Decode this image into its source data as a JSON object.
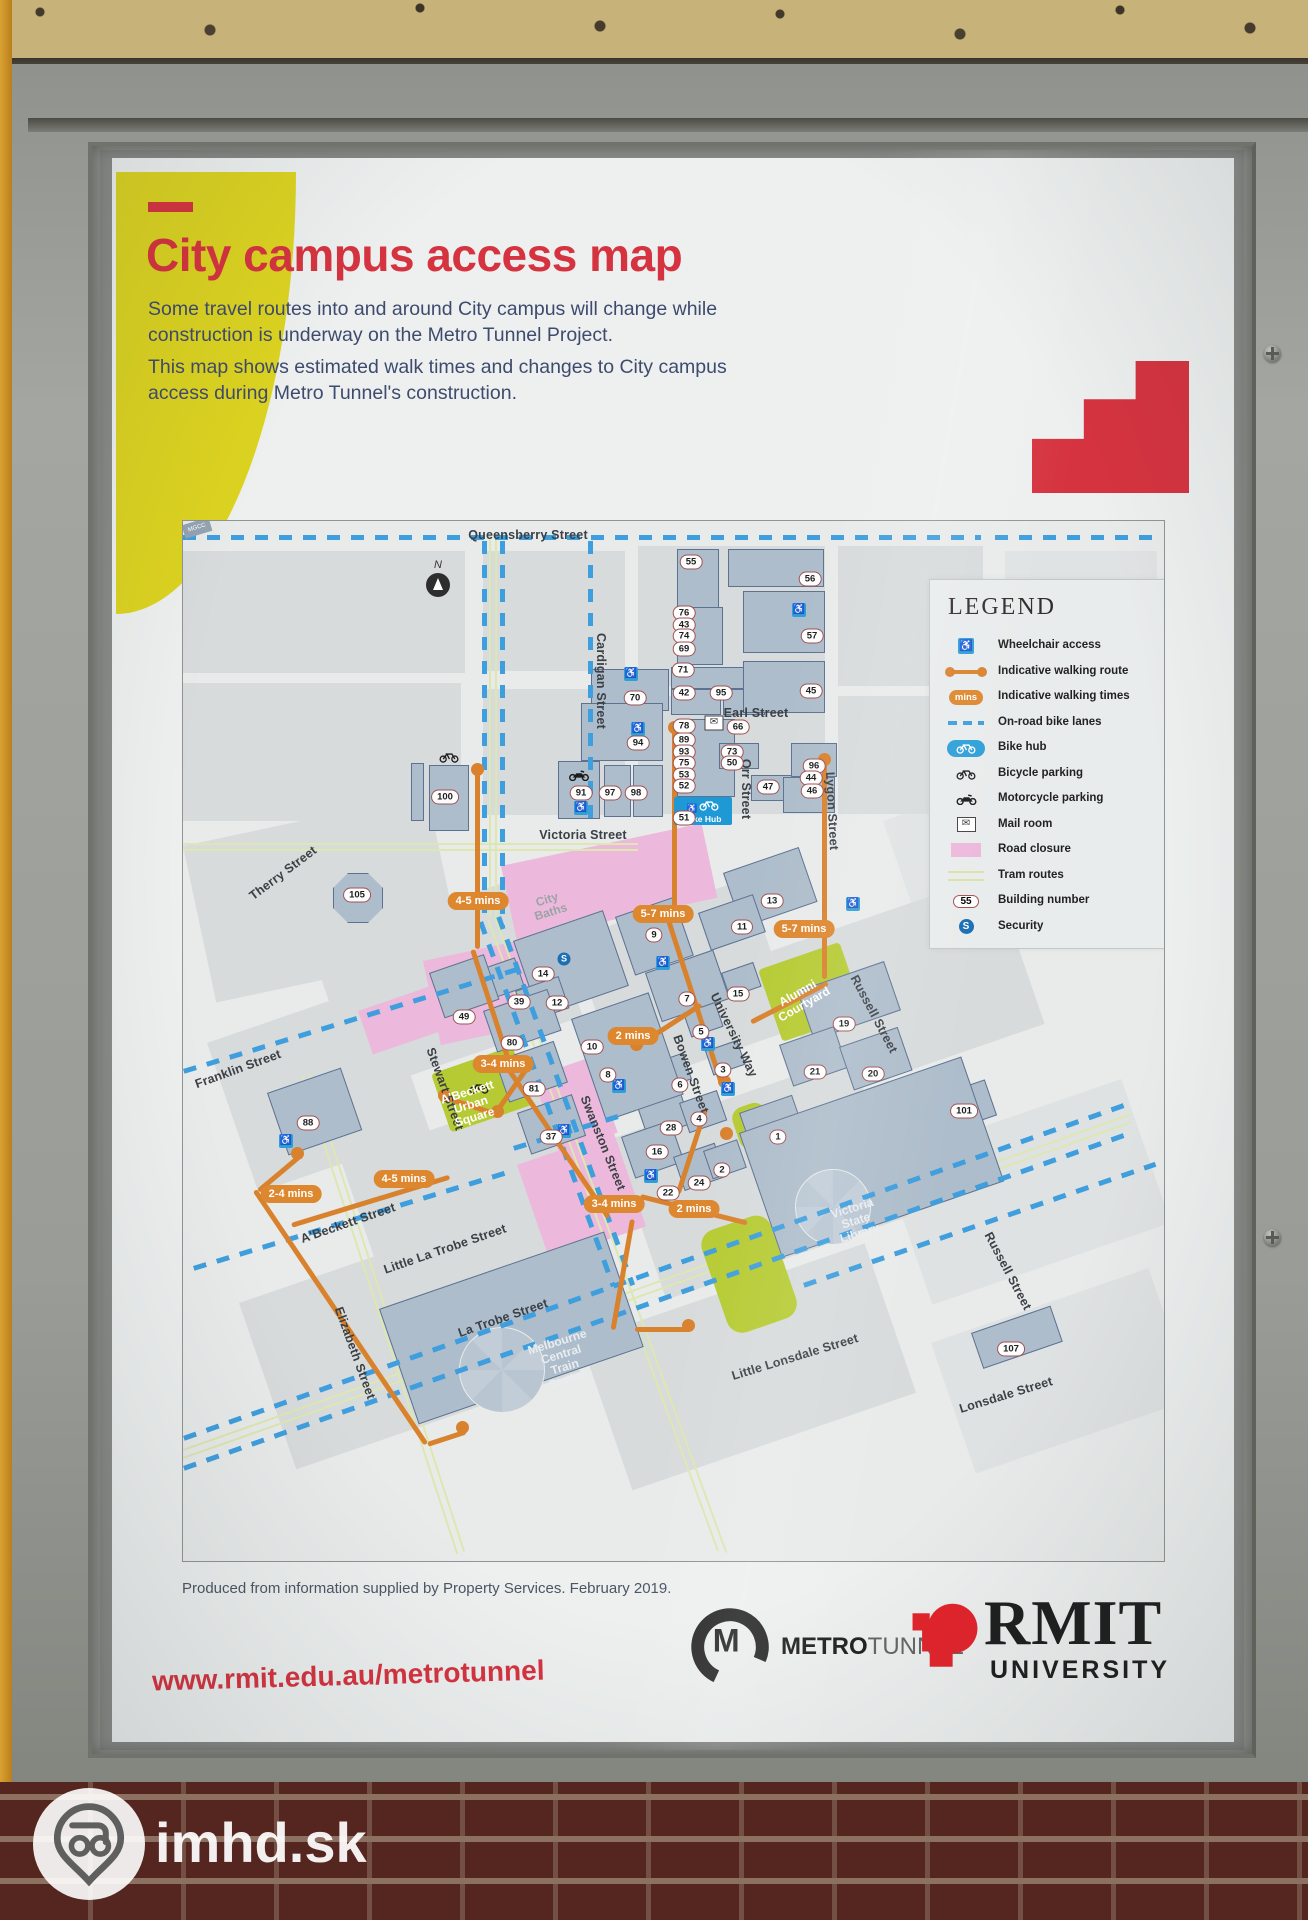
{
  "watermark": {
    "text": "imhd.sk"
  },
  "poster": {
    "title": "City campus access map",
    "intro1": "Some travel routes into and around City campus will change while\nconstruction is underway on the Metro Tunnel Project.",
    "intro2": "This map shows estimated walk times and changes to City campus\naccess during Metro Tunnel's construction.",
    "footnote": "Produced from information supplied by Property Services. February 2019.",
    "url": "www.rmit.edu.au/metrotunnel",
    "logos": {
      "metro_bold": "METRO",
      "metro_light": "TUNNEL",
      "rmit": "RMIT",
      "rmit_sub": "UNIVERSITY"
    }
  },
  "colors": {
    "title_red": "#d5333f",
    "rmit_red": "#e3242b",
    "route_orange": "#d9822e",
    "bike_lane_blue": "#3f9edd",
    "closure_pink": "#ecb9dc",
    "courtyard_green": "#b6cb33",
    "building_fill": "#aebdcb",
    "accent_yellow": "#dcd320",
    "bike_hub_blue": "#1f99d6"
  },
  "legend": {
    "title": "LEGEND",
    "mins_label": "mins",
    "building_number_sample": "55",
    "security_letter": "S",
    "items": [
      {
        "icon": "wheelchair-icon",
        "label": "Wheelchair access"
      },
      {
        "icon": "walking-route-icon",
        "label": "Indicative walking route"
      },
      {
        "icon": "walking-times-icon",
        "label": "Indicative walking times"
      },
      {
        "icon": "bike-lanes-icon",
        "label": "On-road bike lanes"
      },
      {
        "icon": "bike-hub-icon",
        "label": "Bike hub"
      },
      {
        "icon": "bicycle-parking-icon",
        "label": "Bicycle parking"
      },
      {
        "icon": "motorcycle-parking-icon",
        "label": "Motorcycle parking"
      },
      {
        "icon": "mail-room-icon",
        "label": "Mail room"
      },
      {
        "icon": "road-closure-icon",
        "label": "Road closure"
      },
      {
        "icon": "tram-routes-icon",
        "label": "Tram routes"
      },
      {
        "icon": "building-number-icon",
        "label": "Building number"
      },
      {
        "icon": "security-icon",
        "label": "Security"
      }
    ]
  },
  "map": {
    "north_label": "N",
    "bike_hub_label": "Bike Hub",
    "station_box_label": "MGCC",
    "street_labels": [
      {
        "text": "Queensberry Street",
        "x": 345,
        "y": 14,
        "rot": 0
      },
      {
        "text": "Cardigan Street",
        "x": 418,
        "y": 160,
        "rot": 90
      },
      {
        "text": "Earl Street",
        "x": 573,
        "y": 192,
        "rot": 0
      },
      {
        "text": "Orr Street",
        "x": 563,
        "y": 268,
        "rot": 90
      },
      {
        "text": "Lygon Street",
        "x": 649,
        "y": 290,
        "rot": 87
      },
      {
        "text": "Victoria Street",
        "x": 400,
        "y": 314,
        "rot": 0
      },
      {
        "text": "Therry Street",
        "x": 100,
        "y": 352,
        "rot": -37
      },
      {
        "text": "Franklin Street",
        "x": 55,
        "y": 548,
        "rot": -20
      },
      {
        "text": "Stewart Street",
        "x": 262,
        "y": 568,
        "rot": 70
      },
      {
        "text": "A'Beckett Street",
        "x": 165,
        "y": 702,
        "rot": -19
      },
      {
        "text": "Elizabeth Street",
        "x": 172,
        "y": 832,
        "rot": 70
      },
      {
        "text": "Little La Trobe Street",
        "x": 262,
        "y": 728,
        "rot": -19
      },
      {
        "text": "La Trobe Street",
        "x": 320,
        "y": 797,
        "rot": -19
      },
      {
        "text": "Swanston Street",
        "x": 420,
        "y": 622,
        "rot": 68
      },
      {
        "text": "Bowen Street",
        "x": 508,
        "y": 553,
        "rot": 70
      },
      {
        "text": "University Way",
        "x": 551,
        "y": 514,
        "rot": 64
      },
      {
        "text": "Russell Street",
        "x": 691,
        "y": 493,
        "rot": 62
      },
      {
        "text": "Russell Street",
        "x": 825,
        "y": 750,
        "rot": 62
      },
      {
        "text": "Little Lonsdale Street",
        "x": 612,
        "y": 836,
        "rot": -17
      },
      {
        "text": "Lonsdale Street",
        "x": 823,
        "y": 874,
        "rot": -17
      }
    ],
    "area_labels": [
      {
        "text": "City\nBaths",
        "x": 366,
        "y": 385,
        "rot": -17,
        "color": "#9aa3a8"
      },
      {
        "text": "A'Beckett\nUrban\nSquare",
        "x": 288,
        "y": 584,
        "rot": -17,
        "color": "#ffffff"
      },
      {
        "text": "Alumni\nCourtyard",
        "x": 618,
        "y": 478,
        "rot": -30,
        "color": "#ffffff"
      },
      {
        "text": "Victoria\nState\nLibrary",
        "x": 673,
        "y": 700,
        "rot": -17,
        "color": "#e9edf0"
      },
      {
        "text": "Melbourne\nCentral\nTrain\nStation",
        "x": 380,
        "y": 840,
        "rot": -17,
        "color": "#e9edf0"
      }
    ],
    "buildings": [
      {
        "n": "55",
        "x": 508,
        "y": 41
      },
      {
        "n": "56",
        "x": 627,
        "y": 58
      },
      {
        "n": "57",
        "x": 629,
        "y": 115
      },
      {
        "n": "45",
        "x": 628,
        "y": 170
      },
      {
        "n": "76",
        "x": 501,
        "y": 92
      },
      {
        "n": "43",
        "x": 501,
        "y": 104
      },
      {
        "n": "74",
        "x": 501,
        "y": 115
      },
      {
        "n": "69",
        "x": 501,
        "y": 128
      },
      {
        "n": "71",
        "x": 500,
        "y": 149
      },
      {
        "n": "42",
        "x": 501,
        "y": 172
      },
      {
        "n": "95",
        "x": 538,
        "y": 172
      },
      {
        "n": "70",
        "x": 452,
        "y": 177
      },
      {
        "n": "94",
        "x": 455,
        "y": 222
      },
      {
        "n": "78",
        "x": 501,
        "y": 205
      },
      {
        "n": "66",
        "x": 555,
        "y": 206
      },
      {
        "n": "89",
        "x": 501,
        "y": 219
      },
      {
        "n": "93",
        "x": 501,
        "y": 231
      },
      {
        "n": "73",
        "x": 549,
        "y": 231
      },
      {
        "n": "75",
        "x": 501,
        "y": 242
      },
      {
        "n": "50",
        "x": 549,
        "y": 242
      },
      {
        "n": "53",
        "x": 501,
        "y": 254
      },
      {
        "n": "52",
        "x": 501,
        "y": 265
      },
      {
        "n": "51",
        "x": 501,
        "y": 297
      },
      {
        "n": "47",
        "x": 585,
        "y": 266
      },
      {
        "n": "96",
        "x": 631,
        "y": 245
      },
      {
        "n": "44",
        "x": 628,
        "y": 257
      },
      {
        "n": "46",
        "x": 629,
        "y": 270
      },
      {
        "n": "91",
        "x": 398,
        "y": 272
      },
      {
        "n": "97",
        "x": 427,
        "y": 272
      },
      {
        "n": "98",
        "x": 453,
        "y": 272
      },
      {
        "n": "100",
        "x": 262,
        "y": 276
      },
      {
        "n": "105",
        "x": 174,
        "y": 374
      },
      {
        "n": "13",
        "x": 589,
        "y": 380
      },
      {
        "n": "11",
        "x": 559,
        "y": 406
      },
      {
        "n": "9",
        "x": 471,
        "y": 414
      },
      {
        "n": "7",
        "x": 504,
        "y": 478
      },
      {
        "n": "15",
        "x": 555,
        "y": 473
      },
      {
        "n": "5",
        "x": 518,
        "y": 511
      },
      {
        "n": "3",
        "x": 540,
        "y": 549
      },
      {
        "n": "6",
        "x": 497,
        "y": 564
      },
      {
        "n": "28",
        "x": 488,
        "y": 607
      },
      {
        "n": "16",
        "x": 474,
        "y": 631
      },
      {
        "n": "4",
        "x": 516,
        "y": 598
      },
      {
        "n": "24",
        "x": 516,
        "y": 662
      },
      {
        "n": "22",
        "x": 485,
        "y": 672
      },
      {
        "n": "2",
        "x": 539,
        "y": 649
      },
      {
        "n": "1",
        "x": 595,
        "y": 616
      },
      {
        "n": "19",
        "x": 661,
        "y": 503
      },
      {
        "n": "21",
        "x": 632,
        "y": 551
      },
      {
        "n": "20",
        "x": 690,
        "y": 553
      },
      {
        "n": "14",
        "x": 360,
        "y": 453
      },
      {
        "n": "12",
        "x": 374,
        "y": 482
      },
      {
        "n": "39",
        "x": 336,
        "y": 481
      },
      {
        "n": "49",
        "x": 281,
        "y": 496
      },
      {
        "n": "80",
        "x": 329,
        "y": 522
      },
      {
        "n": "81",
        "x": 351,
        "y": 568
      },
      {
        "n": "37",
        "x": 368,
        "y": 616
      },
      {
        "n": "10",
        "x": 409,
        "y": 526
      },
      {
        "n": "8",
        "x": 425,
        "y": 554
      },
      {
        "n": "88",
        "x": 125,
        "y": 602
      },
      {
        "n": "101",
        "x": 781,
        "y": 590
      },
      {
        "n": "107",
        "x": 828,
        "y": 828
      }
    ],
    "walk_times": [
      {
        "t": "4-5 mins",
        "x": 295,
        "y": 380
      },
      {
        "t": "5-7 mins",
        "x": 480,
        "y": 393
      },
      {
        "t": "5-7 mins",
        "x": 621,
        "y": 408
      },
      {
        "t": "2 mins",
        "x": 450,
        "y": 515
      },
      {
        "t": "3-4 mins",
        "x": 320,
        "y": 543
      },
      {
        "t": "4-5 mins",
        "x": 221,
        "y": 658
      },
      {
        "t": "2-4 mins",
        "x": 108,
        "y": 673
      },
      {
        "t": "3-4 mins",
        "x": 431,
        "y": 683
      },
      {
        "t": "2 mins",
        "x": 511,
        "y": 688
      }
    ]
  }
}
